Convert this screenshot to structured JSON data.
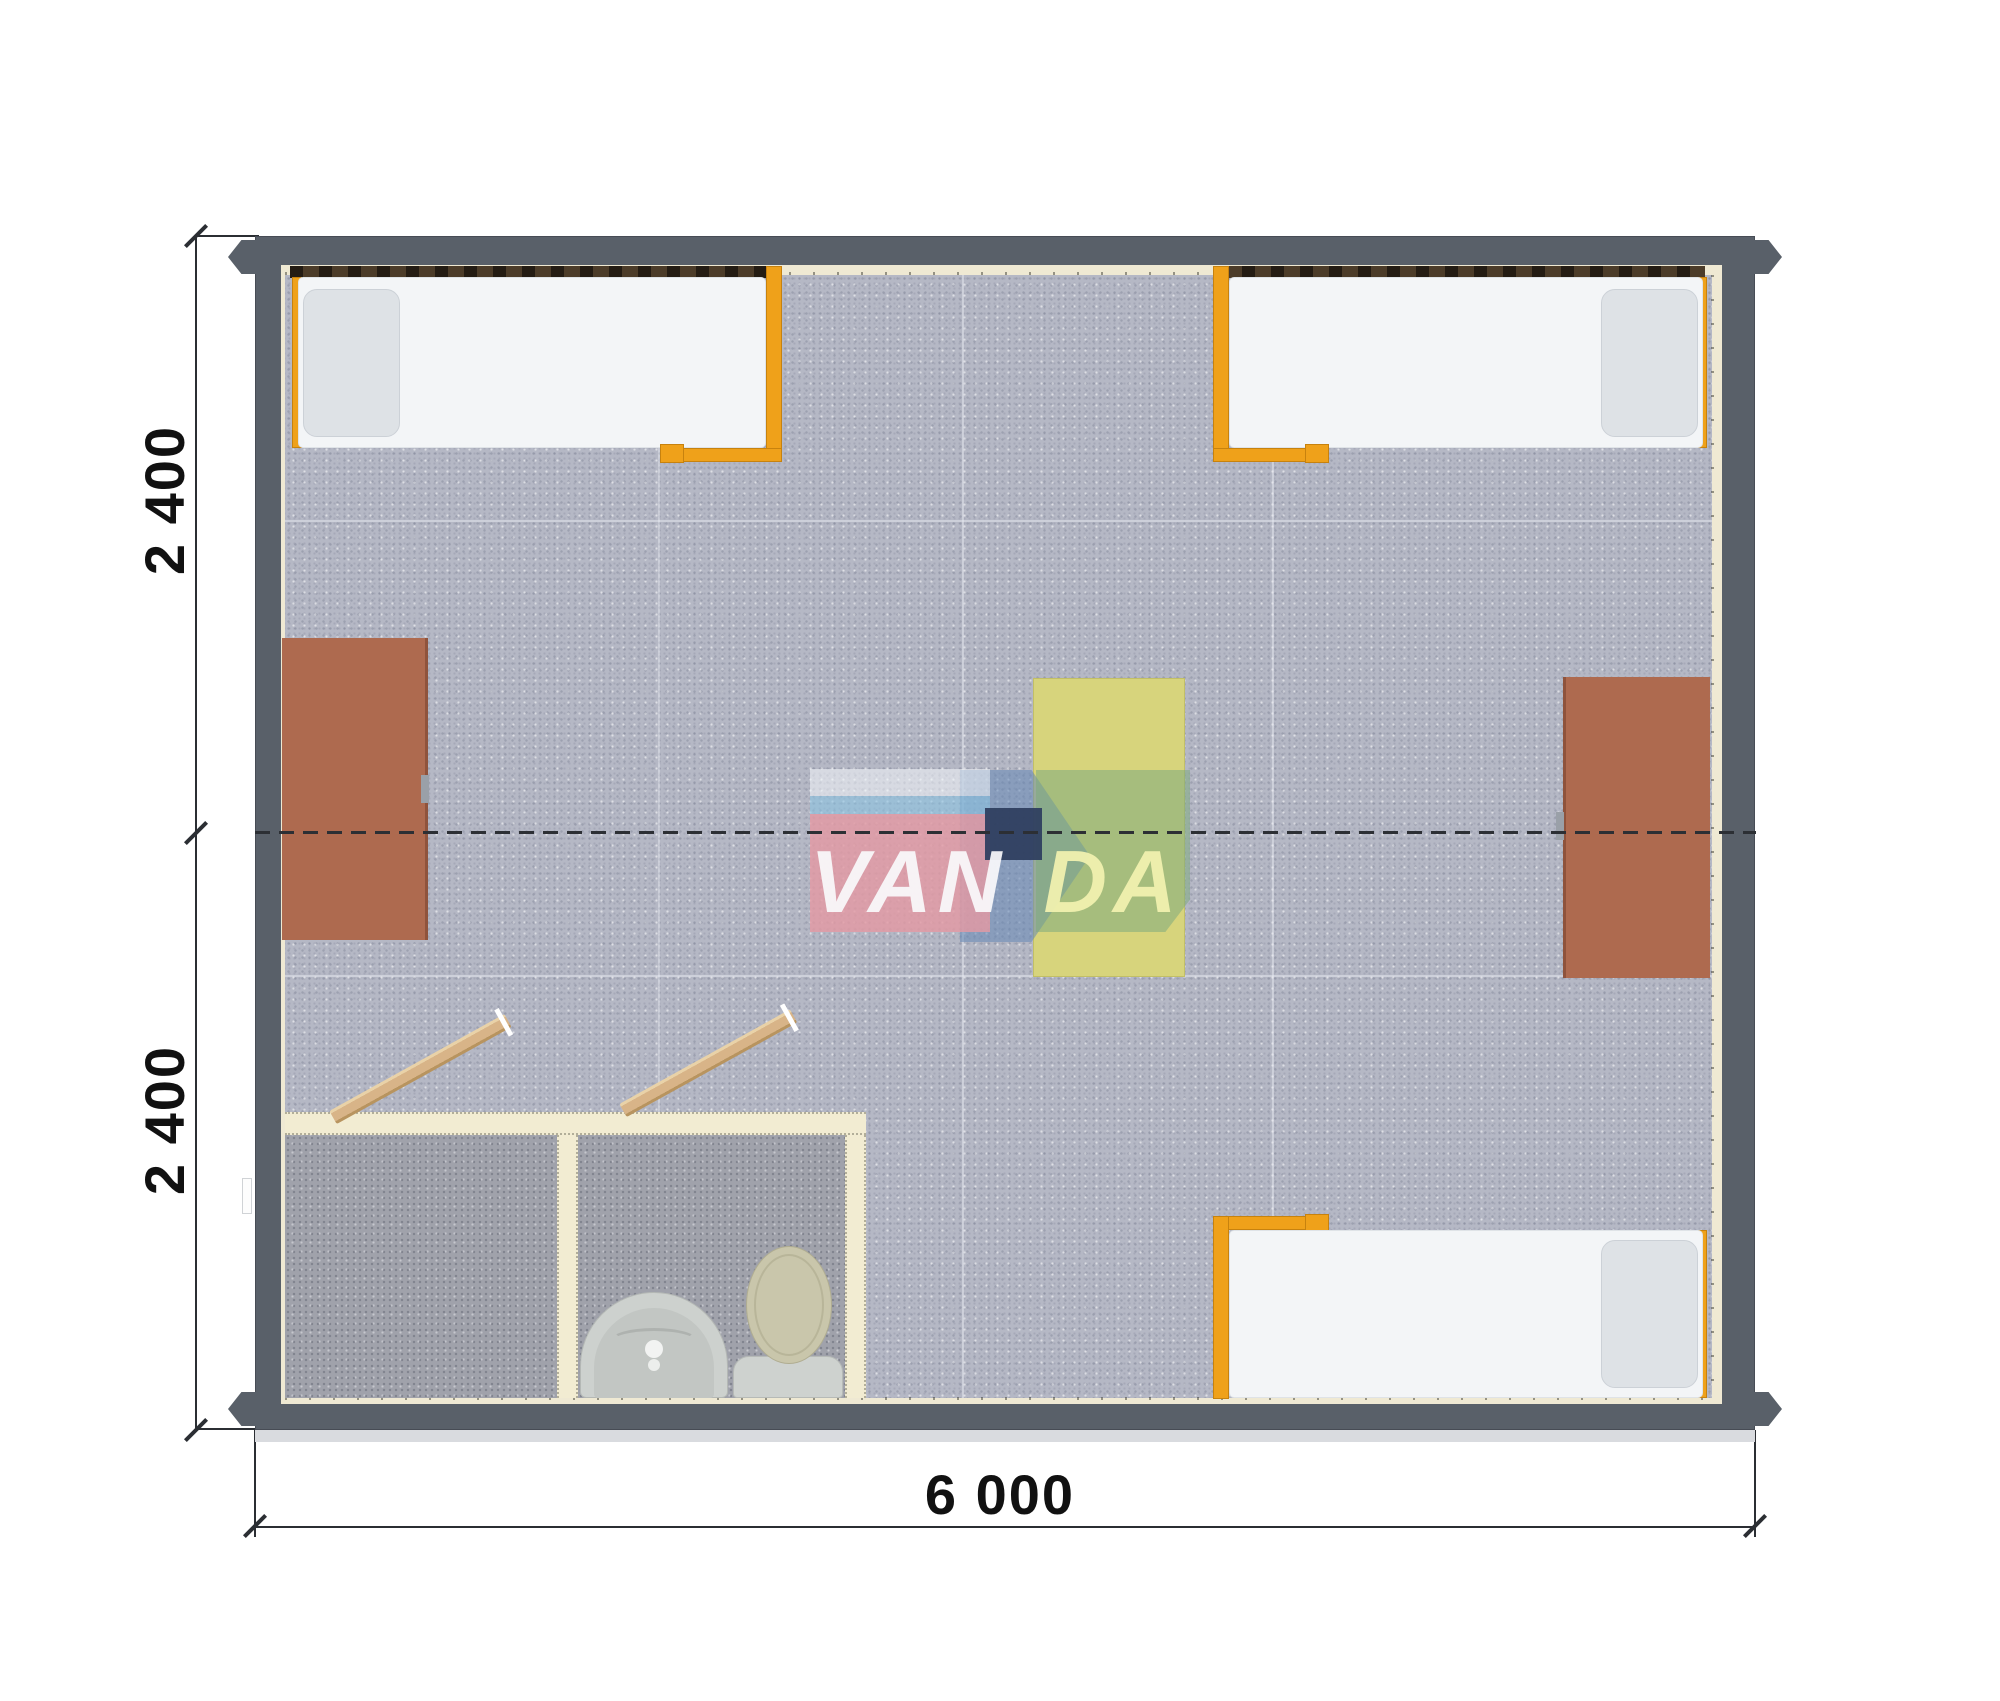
{
  "diagram": {
    "type": "modular-cabin-floor-plan",
    "watermark": {
      "brand": "VANDA",
      "left_letters": "VAN",
      "right_letters": "DA"
    },
    "dimensions": {
      "left_top": "2 400",
      "left_bottom": "2 400",
      "bottom": "6 000"
    },
    "rooms": {
      "main_room_furniture": [
        "bed-top-left",
        "bed-top-right",
        "bed-bottom-right",
        "desk-left",
        "desk-right",
        "table-center"
      ],
      "bathroom_furniture": [
        "sink",
        "toilet",
        "door-shower-room",
        "door-toilet-room"
      ]
    },
    "colors": {
      "wall": "#596069",
      "wall_liner": "#efe9d3",
      "floor": "#b5b8c5",
      "bathroom_floor": "#a0a2ab",
      "bed_frame_orange": "#efa11a",
      "desk_brown": "#ae6a4f",
      "table_yellow": "#d7d47c",
      "door_tan": "#d8b488",
      "watermark_pink": "#e39aa3",
      "watermark_green": "#7daa7d",
      "watermark_navy": "#2f3f60",
      "dimension_line": "#2b2e33"
    }
  }
}
